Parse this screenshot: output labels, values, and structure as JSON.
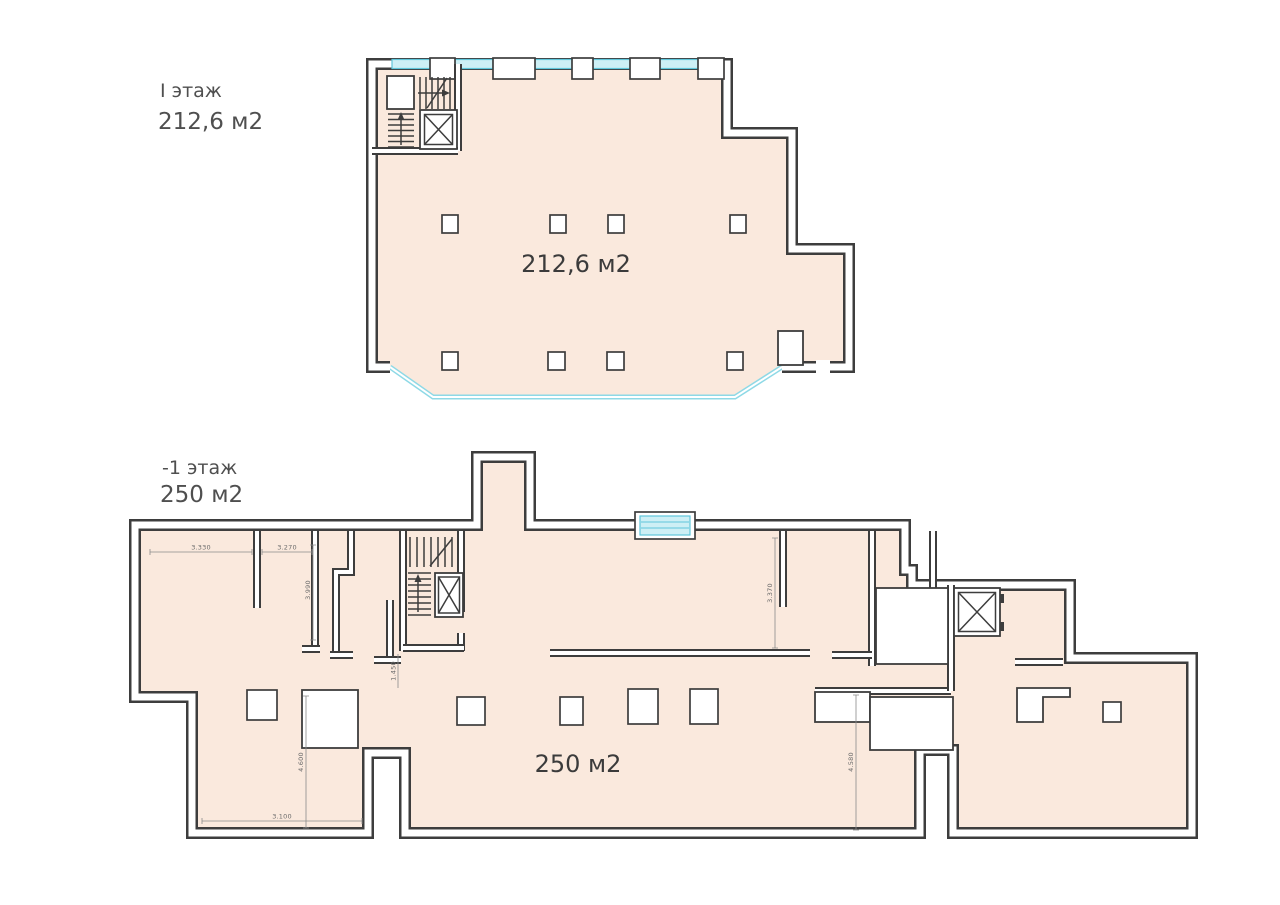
{
  "document": {
    "type": "floor-plan-drawing",
    "background": "#ffffff"
  },
  "colors": {
    "floor_fill": "#fae9dd",
    "wall": "#3d3d3d",
    "glass_line": "#5fc6da",
    "glass_fill": "#cdeff5",
    "dimension": "#8a8a8a",
    "label_text": "#3b3b3b"
  },
  "floor1": {
    "caption_line1": "I этаж",
    "caption_line2": "212,6 м2",
    "area_label": "212,6 м2"
  },
  "floor_minus1": {
    "caption_line1": "-1 этаж",
    "caption_line2": "250 м2",
    "area_label": "250 м2"
  },
  "dims": {
    "d1": "3.330",
    "d2": "3.270",
    "d3": "3.990",
    "d4": "1.450",
    "d5": "3.370",
    "d6": "4.600",
    "d7": "3.100",
    "d8": "4.580"
  }
}
